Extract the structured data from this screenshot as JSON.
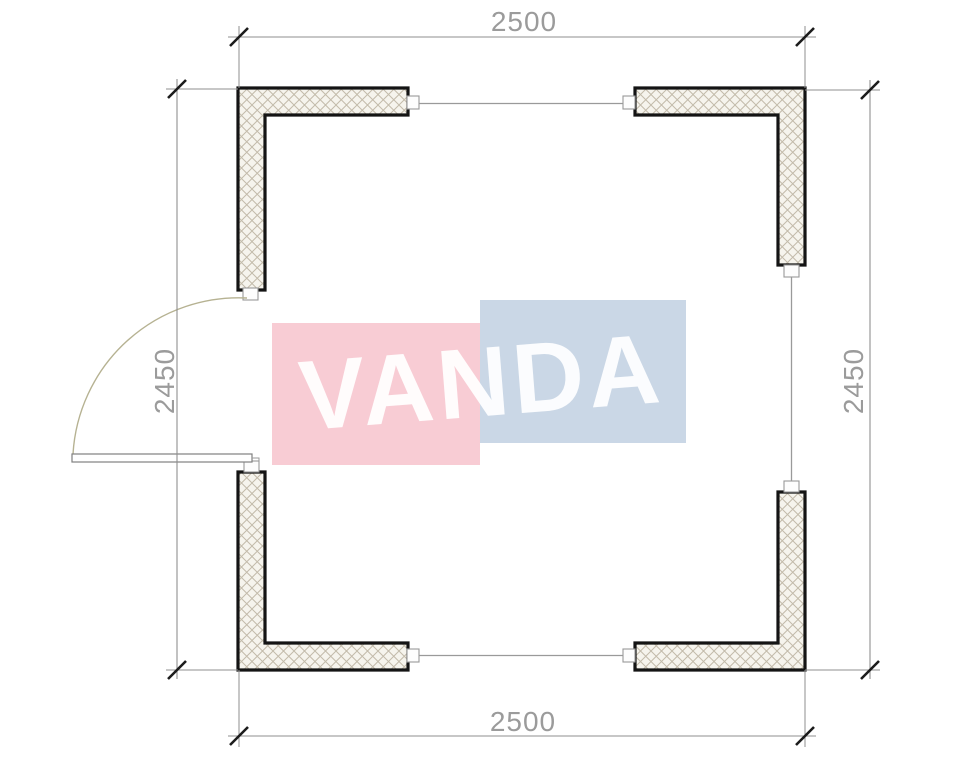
{
  "watermark": {
    "text": "VANDA",
    "pink_fill": "#f8ccd4",
    "blue_fill": "#cad7e6",
    "text_color": "rgba(255,255,255,0.93)"
  },
  "dimensions": {
    "top": "2500",
    "bottom": "2500",
    "left": "2450",
    "right": "2450"
  },
  "colors": {
    "wall_outline": "#141414",
    "wall_fill": "#f6f4ed",
    "hatch_line": "#c3bbaa",
    "dim_line": "#8f8f8f",
    "dim_text": "#9b9b9b",
    "tick": "#1c1c1c",
    "door_arc": "#b6b292",
    "door_leaf_outline": "#808080",
    "window_line": "#9a9a9a",
    "cap_fill": "#fdfdfd",
    "cap_outline": "#999999"
  }
}
